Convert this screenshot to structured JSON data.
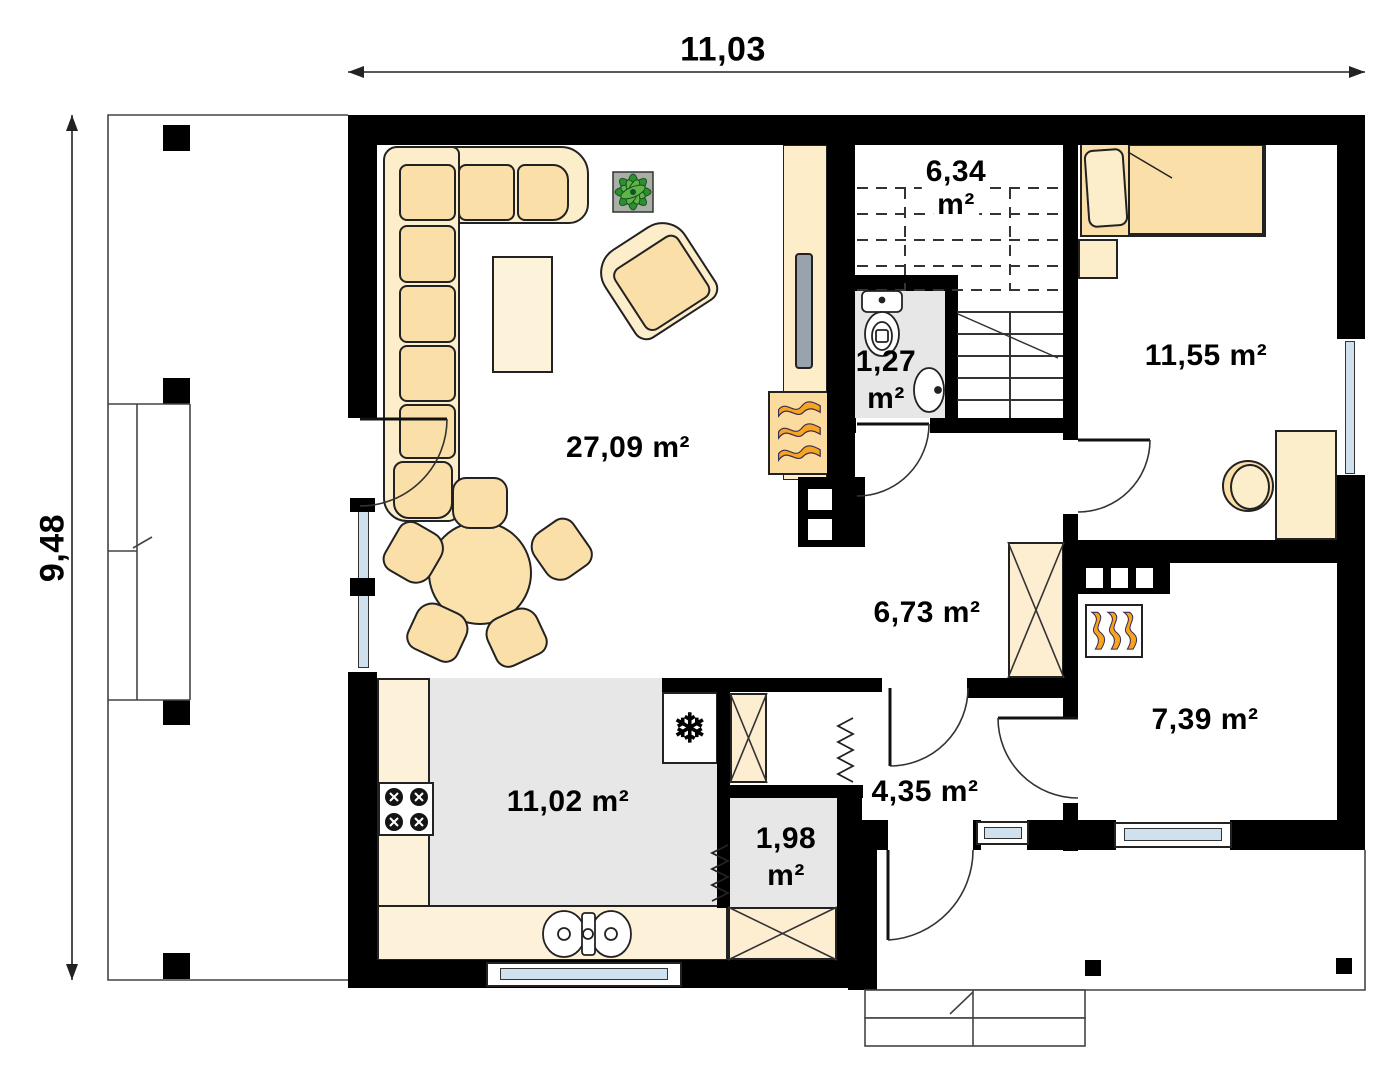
{
  "dimensions": {
    "width": "11,03",
    "height": "9,48"
  },
  "rooms": {
    "living": {
      "area": "27,09 m²"
    },
    "staircase": {
      "line1": "6,34",
      "line2": "m²"
    },
    "wc": {
      "line1": "1,27",
      "line2": "m²"
    },
    "bedroom": {
      "area": "11,55 m²"
    },
    "hall": {
      "area": "6,73 m²"
    },
    "boiler_room": {
      "area": "7,39 m²"
    },
    "kitchen": {
      "area": "11,02 m²"
    },
    "entry_hall": {
      "area": "4,35 m²"
    },
    "pantry": {
      "line1": "1,98",
      "line2": "m²"
    }
  },
  "icons": {
    "fridge_glyph": "❄",
    "fridge_icon": "snowflake",
    "fireplace_icon": "flames",
    "boiler_icon": "flames",
    "wardrobe_icon": "crossed-box",
    "radiator_icon": "zigzag"
  },
  "palette": {
    "wall": "#000000",
    "floor_gray": "#e7e7e7",
    "furniture_cream": "#fbdfa8",
    "furniture_light": "#fdeecb",
    "counter": "#fdf1da",
    "window_glass": "#cfe0ef",
    "flame_orange": "#f6a51c",
    "plant_green": "#2f8f2f",
    "tv_gray": "#99a3ae"
  }
}
